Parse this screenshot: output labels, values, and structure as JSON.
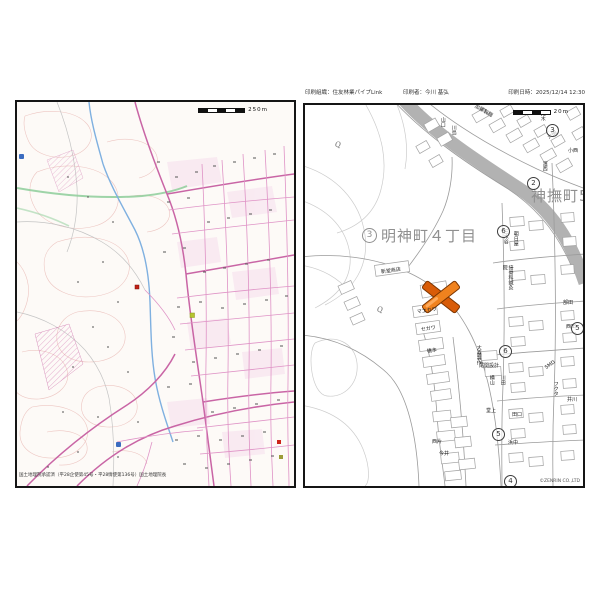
{
  "print_header": {
    "organization": "印刷組織：住友林業パイプLink",
    "printed_by": "印刷者：今川 基弘",
    "printed_at": "印刷日時：2025/12/14 12:30"
  },
  "left_map": {
    "scale_label": "250m",
    "attribution": "国土地理院承認済（平28企使第45号・平28情使第136号）国土地理院長"
  },
  "right_map": {
    "scale_label": "20m",
    "copyright": "©ZENRIN CO.,LTD",
    "district_labels": [
      {
        "circle_n": "3",
        "text": "明神町４丁目"
      },
      {
        "text": "神撫町5"
      }
    ],
    "circled_numbers": [
      {
        "n": "3"
      },
      {
        "n": "2"
      },
      {
        "n": "6"
      },
      {
        "n": "5"
      },
      {
        "n": "6"
      },
      {
        "n": "5"
      },
      {
        "n": "4"
      }
    ],
    "q_symbol": "Q",
    "labels": [
      {
        "text": "荒木"
      },
      {
        "text": "大田"
      },
      {
        "text": "濱西"
      },
      {
        "text": "部田"
      },
      {
        "text": "三木谷"
      },
      {
        "text": "朝日屋"
      },
      {
        "text": "接骨科鍼灸院"
      },
      {
        "text": "新堂商店"
      },
      {
        "text": "マエカワ"
      },
      {
        "text": "セガワ"
      },
      {
        "text": "橋本"
      },
      {
        "text": "加藤製麺"
      },
      {
        "text": "山口"
      },
      {
        "text": "川島"
      },
      {
        "text": "大森製作"
      },
      {
        "text": "尾関設計"
      },
      {
        "text": "横山"
      },
      {
        "text": "川田"
      },
      {
        "text": "SMD"
      },
      {
        "text": "フクタ"
      },
      {
        "text": "井川"
      },
      {
        "text": "堂上"
      },
      {
        "text": "田口"
      },
      {
        "text": "浜中"
      },
      {
        "text": "西片"
      },
      {
        "text": "今井"
      },
      {
        "text": "小西"
      },
      {
        "text": "西田"
      }
    ]
  }
}
